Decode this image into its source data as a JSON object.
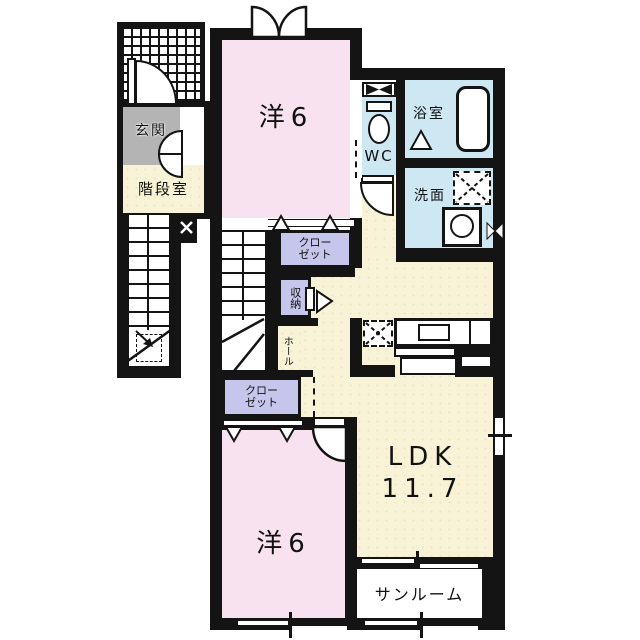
{
  "title": "apartment-floor-plan",
  "colors": {
    "wall": "#141414",
    "pink": "#f9e2ef",
    "cream": "#f8f3d6",
    "blue": "#cde7f3",
    "lavender": "#c6c6ec",
    "gray": "#b4b4b4"
  },
  "rooms": {
    "genkan": {
      "label": "玄関"
    },
    "stairwell": {
      "label": "階段室"
    },
    "bedroom_top": {
      "label": "洋6"
    },
    "wc": {
      "label": "WC"
    },
    "bath": {
      "label": "浴室"
    },
    "washroom": {
      "label": "洗面"
    },
    "closet_top": {
      "line1": "クロー",
      "line2": "ゼット"
    },
    "storage": {
      "label": "収納"
    },
    "hall": {
      "label": "ホール"
    },
    "closet_bottom": {
      "line1": "クロー",
      "line2": "ゼット"
    },
    "ldk": {
      "line1": "LDK",
      "line2": "11.7"
    },
    "bedroom_bottom": {
      "label": "洋6"
    },
    "sunroom": {
      "label": "サンルーム"
    }
  }
}
